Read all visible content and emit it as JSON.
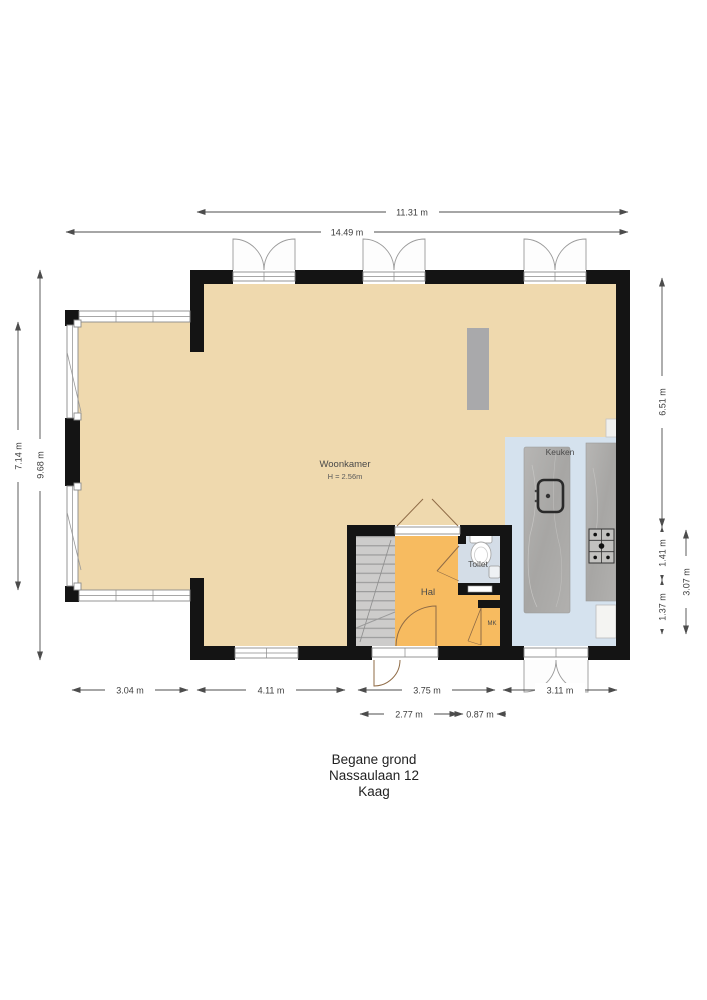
{
  "title": {
    "lines": [
      "Begane grond",
      "Nassaulaan 12",
      "Kaag"
    ]
  },
  "rooms": {
    "woonkamer": {
      "label": "Woonkamer",
      "height_note": "H = 2.56m"
    },
    "keuken": {
      "label": "Keuken"
    },
    "toilet": {
      "label": "Toilet"
    },
    "hal": {
      "label": "Hal"
    },
    "mk": {
      "label": "MK"
    }
  },
  "dims": {
    "top_inner": "11.31 m",
    "top_outer": "14.49 m",
    "left_inner": "7.14 m",
    "left_outer": "9.68 m",
    "right_upper": "6.51 m",
    "right_mid": "1.41 m",
    "right_lower": "1.37 m",
    "right_outer": "3.07 m",
    "bottom_bay": "3.04 m",
    "bottom_woonkamer": "4.11 m",
    "bottom_hal": "3.75 m",
    "bottom_keuken": "3.11 m",
    "bottom_hal_inner": "2.77 m",
    "bottom_toilet": "0.87 m"
  },
  "colors": {
    "woonkamer_floor": "#efd9ae",
    "hal_floor": "#f7bb60",
    "keuken_floor": "#d5e2ee",
    "toilet_floor": "#d4dde7",
    "stairs": "#cdcccb",
    "counter": "#a9a8a6",
    "wall": "#141414"
  }
}
